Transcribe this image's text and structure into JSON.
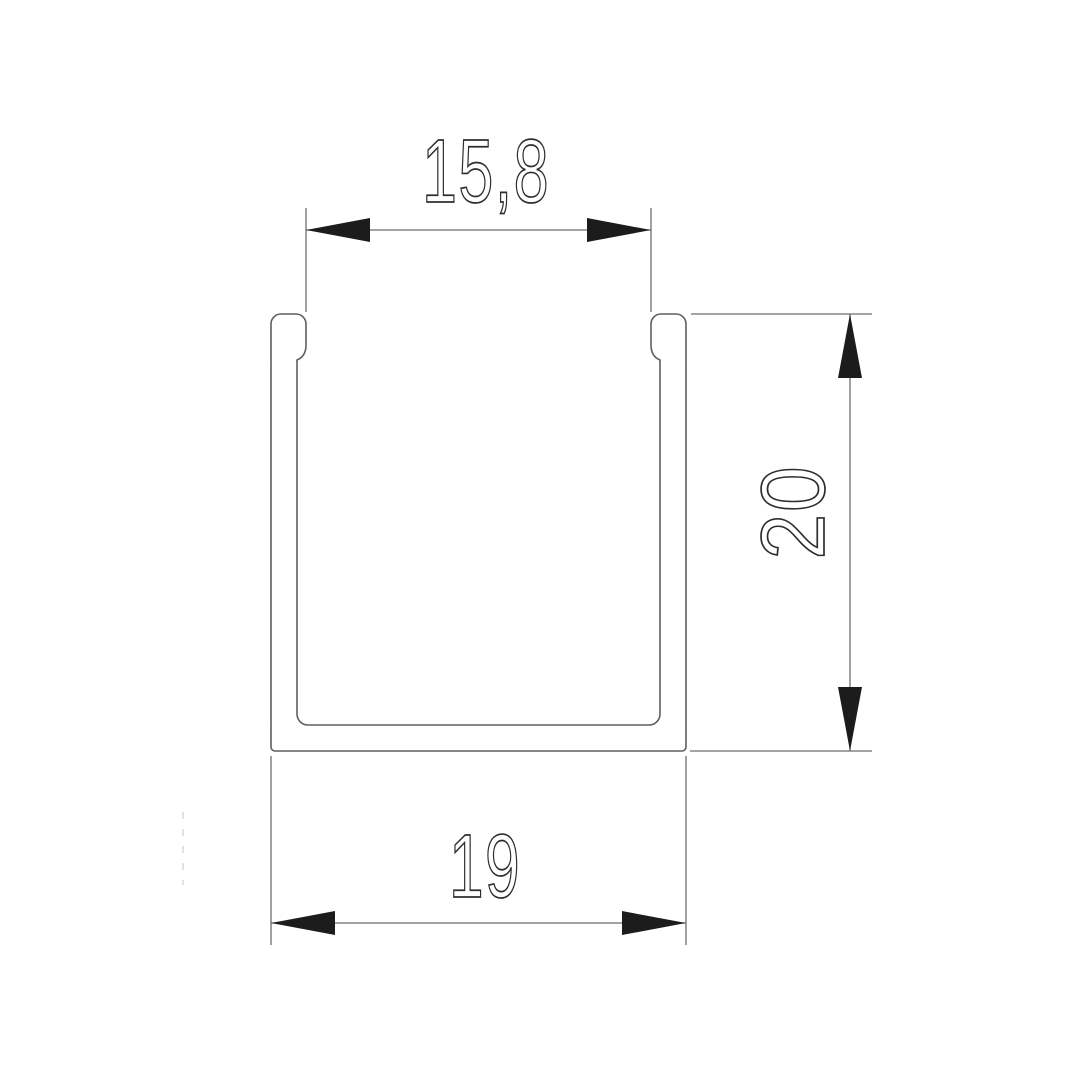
{
  "drawing": {
    "dimensions": {
      "top_opening": {
        "value": "15,8"
      },
      "height": {
        "value": "20"
      },
      "outer_width": {
        "value": "19"
      }
    },
    "colors": {
      "background": "#ffffff",
      "profile_outline": "#5f5f5f",
      "dimension_line": "#6e6e6e",
      "extension_line": "#6e6e6e",
      "arrowhead": "#1c1c1c",
      "text_stroke": "#2e2e2e",
      "faint_dashed": "#d9d9d9"
    }
  }
}
